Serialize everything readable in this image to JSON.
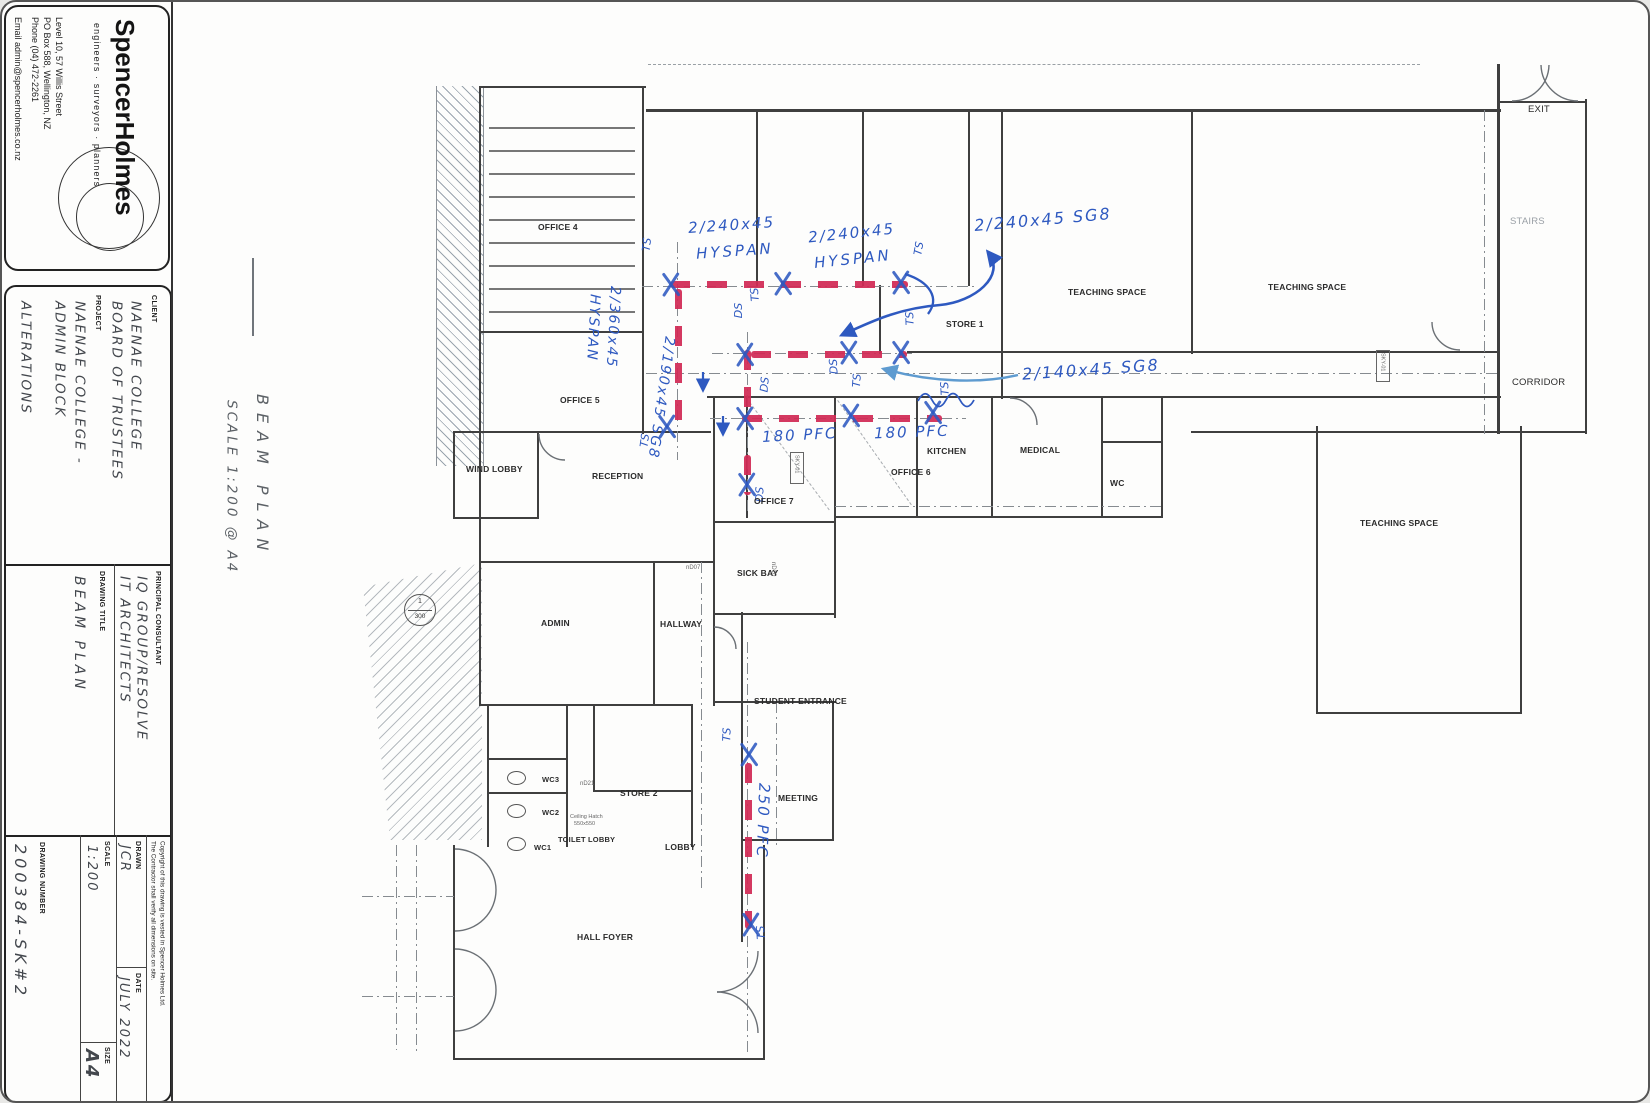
{
  "sheet": {
    "firm": {
      "name": "SpencerHolmes",
      "tagline": "engineers · surveyors · planners",
      "address1": "Level 10, 57 Willis Street",
      "address2": "PO Box 588, Wellington, NZ",
      "address3": "Phone (04) 472-2261",
      "address4": "Email admin@spencerholmes.co.nz"
    },
    "client": {
      "label": "CLIENT",
      "name1": "NAENAE COLLEGE",
      "name2": "BOARD OF TRUSTEES",
      "project_label": "PROJECT",
      "project1": "NAENAE COLLEGE -",
      "project2": "ADMIN BLOCK",
      "project3": "ALTERATIONS"
    },
    "consultant": {
      "label": "PRINCIPAL CONSULTANT",
      "name1": "IQ GROUP/RESOLVE",
      "name2": "IT ARCHITECTS",
      "title_label": "DRAWING TITLE",
      "title": "BEAM PLAN"
    },
    "issue": {
      "drawn_label": "DRAWN",
      "drawn": "JCR",
      "date_label": "DATE",
      "date": "JULY 2022",
      "scale_label": "SCALE",
      "scale": "1:200",
      "size_label": "SIZE",
      "size": "A4",
      "number_label": "DRAWING NUMBER",
      "number": "200384-SK#2",
      "copyright1": "Copyright of this drawing is vested in Spencer Holmes Ltd.",
      "copyright2": "The Contractor shall verify all dimensions on site."
    }
  },
  "note": {
    "title": "BEAM PLAN",
    "scale": "SCALE 1:200 @ A4"
  },
  "plan": {
    "rooms": {
      "office4": "OFFICE 4",
      "office5": "OFFICE 5",
      "wind_lobby": "WIND LOBBY",
      "reception": "RECEPTION",
      "admin": "ADMIN",
      "hallway": "HALLWAY",
      "sick_bay": "SICK BAY",
      "student_entrance": "STUDENT ENTRANCE",
      "meeting": "MEETING",
      "store2": "STORE 2",
      "toilet_lobby": "TOILET LOBBY",
      "lobby": "LOBBY",
      "wc1": "WC1",
      "wc2": "WC2",
      "wc3": "WC3",
      "hall_foyer": "HALL FOYER",
      "office7": "OFFICE 7",
      "office6": "OFFICE 6",
      "kitchen": "KITCHEN",
      "medical": "MEDICAL",
      "wc": "WC",
      "store1": "STORE 1",
      "teaching_a": "TEACHING SPACE",
      "teaching_b": "TEACHING SPACE",
      "teaching_c": "TEACHING SPACE",
      "corridor": "CORRIDOR",
      "exit": "EXIT",
      "stairs": "STAIRS"
    },
    "tags": {
      "nd07": "nD07",
      "nd10": "nD10",
      "nd21": "nD21",
      "sky": "SKY-01",
      "hatch1": "Ceiling Hatch",
      "hatch2": "550x550",
      "bubble_num": "1",
      "bubble_den": "300"
    },
    "beams": {
      "hyspan_a1": "2/240x45",
      "hyspan_a2": "HYSPAN",
      "hyspan_b1": "2/240x45",
      "hyspan_b2": "HYSPAN",
      "sg8_240": "2/240x45 SG8",
      "hyspan360_1": "2/360x45",
      "hyspan360_2": "HYSPAN",
      "sg8_190": "2/190x45 SG8",
      "pfc180_a": "180 PFC",
      "pfc180_b": "180 PFC",
      "sg8_140": "2/140x45 SG8",
      "pfc250": "250 PFC"
    },
    "marks": {
      "ts": "TS",
      "ds": "DS"
    },
    "colors": {
      "beam": "#d12a55",
      "ink": "#2e59c0",
      "pencil": "#5c6166",
      "wall": "#3f3f3f"
    }
  }
}
